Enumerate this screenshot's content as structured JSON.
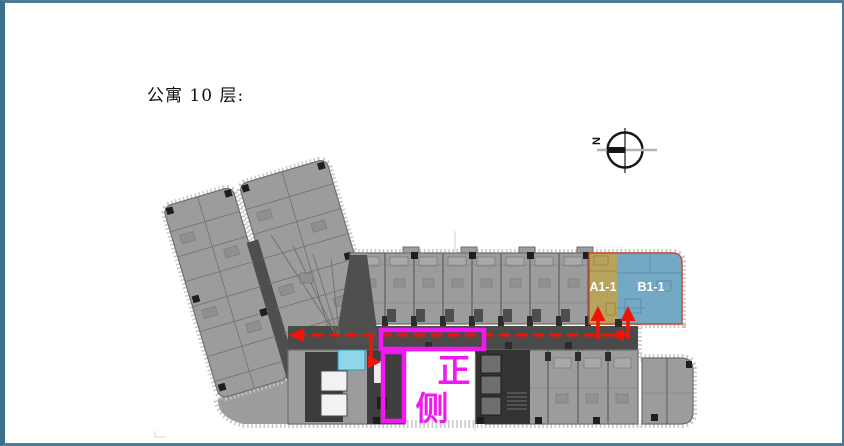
{
  "page": {
    "title": "公寓 10 层:",
    "background": "#ffffff",
    "border_color": "#4b7b97"
  },
  "north_indicator": {
    "label": "N"
  },
  "floor_plan": {
    "building_fill": "#9c9c9c",
    "corridor_fill": "#4a4a4a",
    "outline_color": "#6f6f6f",
    "dark_core_fill": "#3b3b3b",
    "units": [
      {
        "label": "A1-1",
        "fill": "#b7a35b",
        "label_color": "#ffffff"
      },
      {
        "label": "B1-1",
        "fill": "#74a9c4",
        "label_color": "#ffffff"
      }
    ],
    "unit_outline_color": "#c64a32",
    "highlighted_room_fill": "#8fd6ec",
    "escape_route_color": "#ee1507"
  },
  "annotations": {
    "color": "#f218f2",
    "front_label": "正",
    "side_label": "侧"
  }
}
